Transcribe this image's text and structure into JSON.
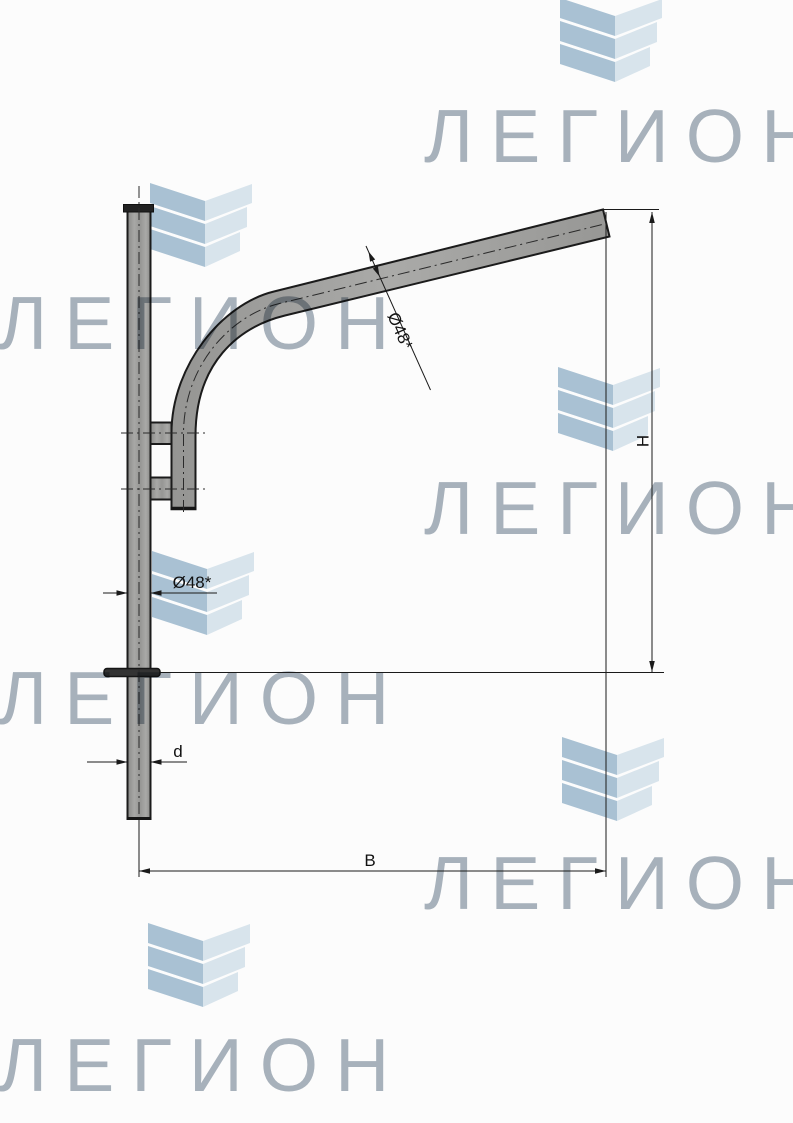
{
  "drawing": {
    "type": "technical-drawing",
    "subject": "single-arm street light bracket on pole, side view",
    "labels": {
      "arm_diameter": "Ø48*",
      "pole_diameter": "Ø48*",
      "height": "H",
      "reach": "B",
      "pole_bottom_diameter": "d"
    },
    "colors": {
      "outline": "#1b1b1b",
      "steel_fill": "#a0a09e",
      "dimension_line": "#1a1a1a"
    }
  },
  "watermark": {
    "text": "ЛЕГИОН",
    "text_color": "#a9b3bd",
    "chevron_dark": "#a9c1d3",
    "chevron_light": "#d8e4ec"
  }
}
